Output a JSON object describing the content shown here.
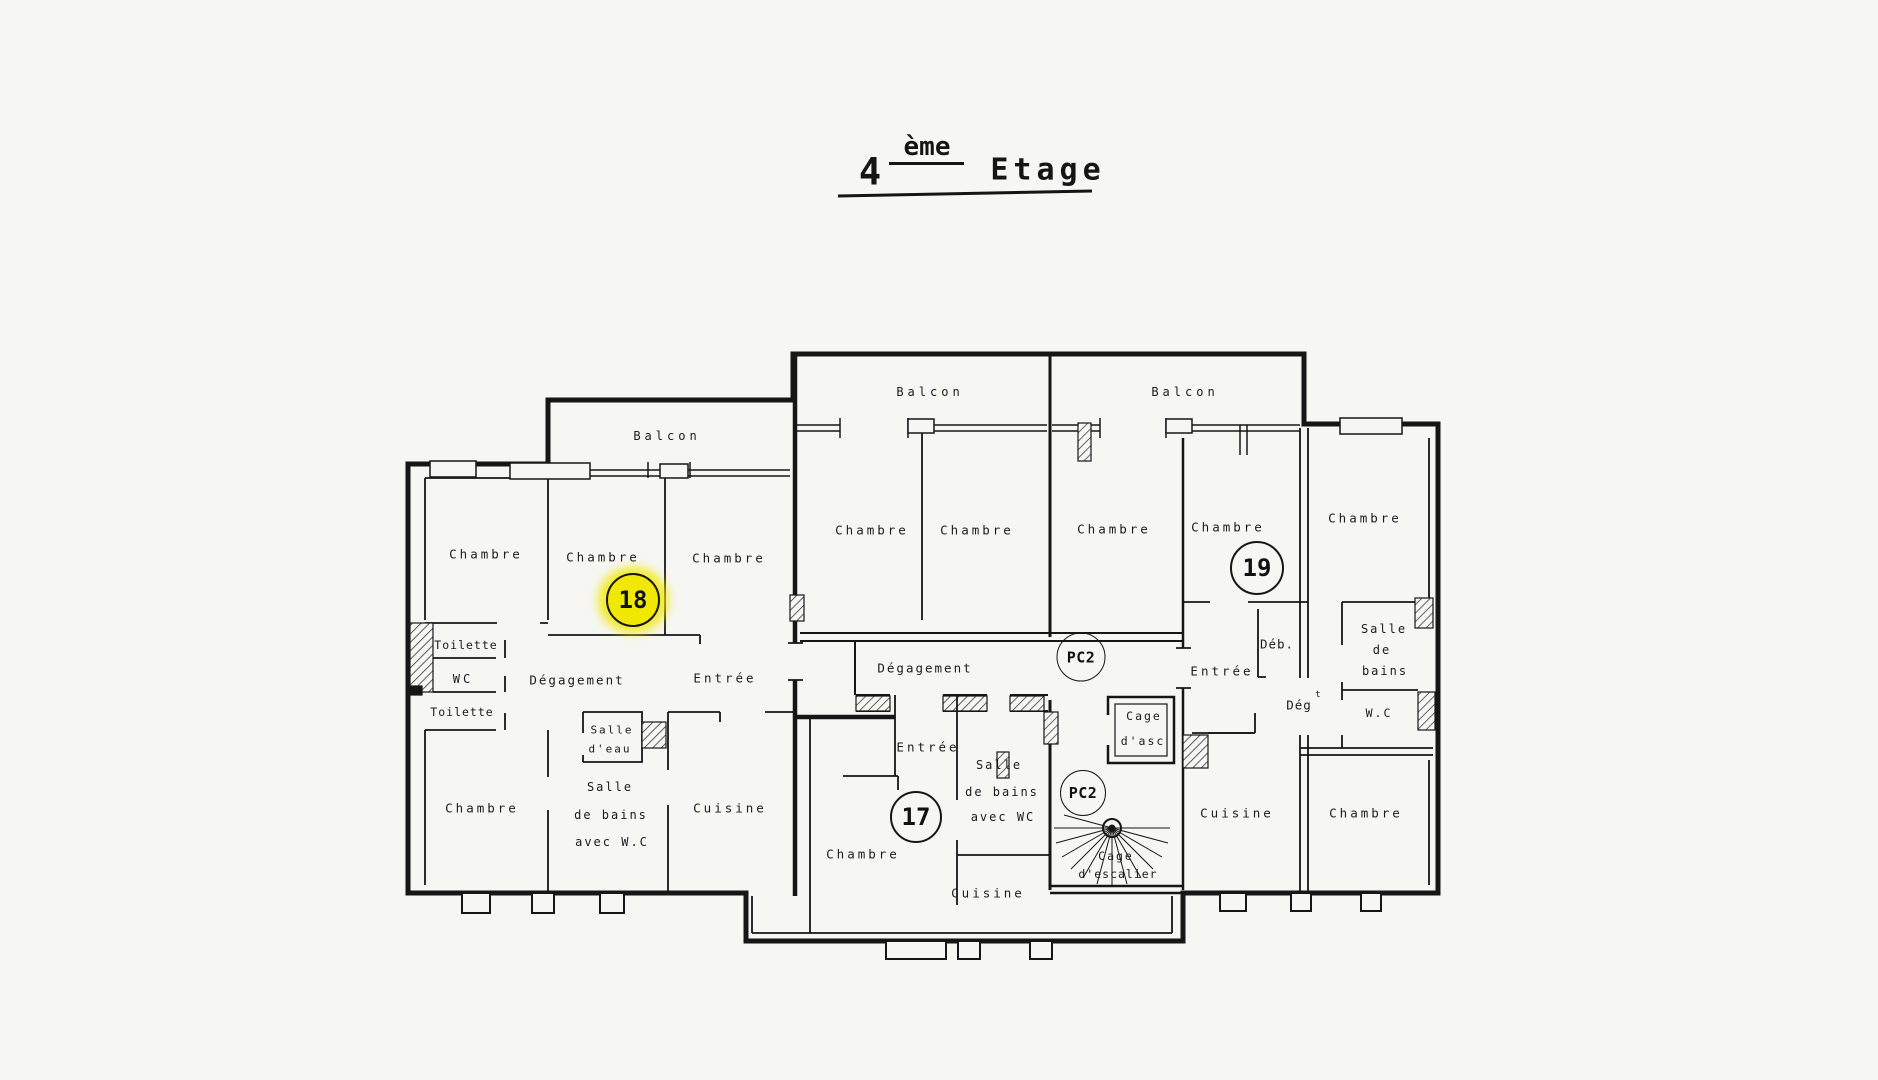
{
  "title": {
    "floor_number": "4",
    "superscript": "ème",
    "word": "Etage"
  },
  "colors": {
    "ink": "#1a1a1a",
    "paper": "#f6f6f3",
    "highlight": "#f1e800"
  },
  "rooms": {
    "labels": [
      {
        "id": "balcon-label-18",
        "text": "Balcon",
        "x": 667,
        "y": 436,
        "size": 12,
        "ls": 4
      },
      {
        "id": "balcon-label-mid",
        "text": "Balcon",
        "x": 930,
        "y": 392,
        "size": 12,
        "ls": 4
      },
      {
        "id": "balcon-label-19",
        "text": "Balcon",
        "x": 1185,
        "y": 392,
        "size": 12,
        "ls": 4
      },
      {
        "id": "chambre-18-a",
        "text": "Chambre",
        "x": 486,
        "y": 554,
        "size": 12.5,
        "ls": 3
      },
      {
        "id": "chambre-18-b",
        "text": "Chambre",
        "x": 603,
        "y": 557,
        "size": 12.5,
        "ls": 3
      },
      {
        "id": "chambre-18-c",
        "text": "Chambre",
        "x": 729,
        "y": 558,
        "size": 12.5,
        "ls": 3
      },
      {
        "id": "chambre-mid-a",
        "text": "Chambre",
        "x": 872,
        "y": 530,
        "size": 12.5,
        "ls": 3
      },
      {
        "id": "chambre-mid-b",
        "text": "Chambre",
        "x": 977,
        "y": 530,
        "size": 12.5,
        "ls": 3
      },
      {
        "id": "chambre-19-a",
        "text": "Chambre",
        "x": 1114,
        "y": 529,
        "size": 12.5,
        "ls": 3
      },
      {
        "id": "chambre-19-b",
        "text": "Chambre",
        "x": 1228,
        "y": 527,
        "size": 12.5,
        "ls": 3
      },
      {
        "id": "chambre-19-c",
        "text": "Chambre",
        "x": 1365,
        "y": 518,
        "size": 12.5,
        "ls": 3
      },
      {
        "id": "toilette-upper",
        "text": "Toilette",
        "x": 466,
        "y": 645,
        "size": 11.5,
        "ls": 1
      },
      {
        "id": "wc-18",
        "text": "WC",
        "x": 463,
        "y": 679,
        "size": 12,
        "ls": 3
      },
      {
        "id": "toilette-lower",
        "text": "Toilette",
        "x": 462,
        "y": 712,
        "size": 11.5,
        "ls": 1
      },
      {
        "id": "degagement-18",
        "text": "Dégagement",
        "x": 577,
        "y": 680,
        "size": 12.5,
        "ls": 2
      },
      {
        "id": "entree-18",
        "text": "Entrée",
        "x": 725,
        "y": 678,
        "size": 12.5,
        "ls": 3
      },
      {
        "id": "salle-eau-line1",
        "text": "Salle",
        "x": 612,
        "y": 730,
        "size": 11,
        "ls": 2
      },
      {
        "id": "salle-eau-line2",
        "text": "d'eau",
        "x": 610,
        "y": 749,
        "size": 11,
        "ls": 2
      },
      {
        "id": "chambre-18-d",
        "text": "Chambre",
        "x": 482,
        "y": 808,
        "size": 12.5,
        "ls": 3
      },
      {
        "id": "sdb-18-line1",
        "text": "Salle",
        "x": 610,
        "y": 787,
        "size": 12,
        "ls": 2
      },
      {
        "id": "sdb-18-line2",
        "text": "de  bains",
        "x": 611,
        "y": 815,
        "size": 12,
        "ls": 2
      },
      {
        "id": "sdb-18-line3",
        "text": "avec  W.C",
        "x": 612,
        "y": 842,
        "size": 12,
        "ls": 2
      },
      {
        "id": "cuisine-18",
        "text": "Cuisine",
        "x": 730,
        "y": 808,
        "size": 12.5,
        "ls": 3
      },
      {
        "id": "degagement-commun",
        "text": "Dégagement",
        "x": 925,
        "y": 668,
        "size": 12.5,
        "ls": 2
      },
      {
        "id": "entree-17",
        "text": "Entrée",
        "x": 928,
        "y": 747,
        "size": 12.5,
        "ls": 3
      },
      {
        "id": "sdb-17-line1",
        "text": "Salle",
        "x": 999,
        "y": 765,
        "size": 12,
        "ls": 2
      },
      {
        "id": "sdb-17-line2",
        "text": "de bains",
        "x": 1002,
        "y": 792,
        "size": 12,
        "ls": 2
      },
      {
        "id": "sdb-17-line3",
        "text": "avec WC",
        "x": 1003,
        "y": 817,
        "size": 12,
        "ls": 2
      },
      {
        "id": "chambre-17",
        "text": "Chambre",
        "x": 863,
        "y": 854,
        "size": 12.5,
        "ls": 3
      },
      {
        "id": "cuisine-17",
        "text": "Cuisine",
        "x": 988,
        "y": 893,
        "size": 12.5,
        "ls": 3
      },
      {
        "id": "cage-asc-line1",
        "text": "Cage",
        "x": 1144,
        "y": 716,
        "size": 11.5,
        "ls": 2
      },
      {
        "id": "cage-asc-line2",
        "text": "d'asc",
        "x": 1143,
        "y": 741,
        "size": 11.5,
        "ls": 2
      },
      {
        "id": "cage-escalier-line1",
        "text": "Cage",
        "x": 1116,
        "y": 856,
        "size": 11.5,
        "ls": 2
      },
      {
        "id": "cage-escalier-line2",
        "text": "d'escalier",
        "x": 1118,
        "y": 874,
        "size": 11.5,
        "ls": 1
      },
      {
        "id": "entree-19",
        "text": "Entrée",
        "x": 1222,
        "y": 671,
        "size": 12.5,
        "ls": 3
      },
      {
        "id": "deb-19",
        "text": "Déb.",
        "x": 1277,
        "y": 644,
        "size": 12.5,
        "ls": 1
      },
      {
        "id": "degt-19",
        "text": "Dég",
        "x": 1299,
        "y": 705,
        "size": 12.5,
        "ls": 1
      },
      {
        "id": "degt-19-sup",
        "text": "t",
        "x": 1318,
        "y": 695,
        "size": 9,
        "ls": 0
      },
      {
        "id": "sdb-19-line1",
        "text": "Salle",
        "x": 1384,
        "y": 629,
        "size": 12,
        "ls": 2
      },
      {
        "id": "sdb-19-line2",
        "text": "de",
        "x": 1382,
        "y": 650,
        "size": 12,
        "ls": 2
      },
      {
        "id": "sdb-19-line3",
        "text": "bains",
        "x": 1385,
        "y": 671,
        "size": 12,
        "ls": 2
      },
      {
        "id": "wc-19",
        "text": "W.C",
        "x": 1379,
        "y": 713,
        "size": 11.5,
        "ls": 2
      },
      {
        "id": "cuisine-19",
        "text": "Cuisine",
        "x": 1237,
        "y": 813,
        "size": 12.5,
        "ls": 3
      },
      {
        "id": "chambre-19-d",
        "text": "Chambre",
        "x": 1366,
        "y": 813,
        "size": 12.5,
        "ls": 3
      }
    ]
  },
  "markers": {
    "circles": [
      {
        "id": "apartment-18-badge",
        "label": "18",
        "x": 633,
        "y": 600,
        "d": 50,
        "type": "apt",
        "highlight": true
      },
      {
        "id": "apartment-19-badge",
        "label": "19",
        "x": 1257,
        "y": 568,
        "d": 50,
        "type": "apt",
        "highlight": false
      },
      {
        "id": "apartment-17-badge",
        "label": "17",
        "x": 916,
        "y": 817,
        "d": 48,
        "type": "apt",
        "highlight": false
      },
      {
        "id": "pc2-upper-badge",
        "label": "PC2",
        "x": 1081,
        "y": 657,
        "d": 47,
        "type": "pc",
        "highlight": false
      },
      {
        "id": "pc2-lower-badge",
        "label": "PC2",
        "x": 1083,
        "y": 793,
        "d": 44,
        "type": "pc",
        "highlight": false
      }
    ]
  }
}
